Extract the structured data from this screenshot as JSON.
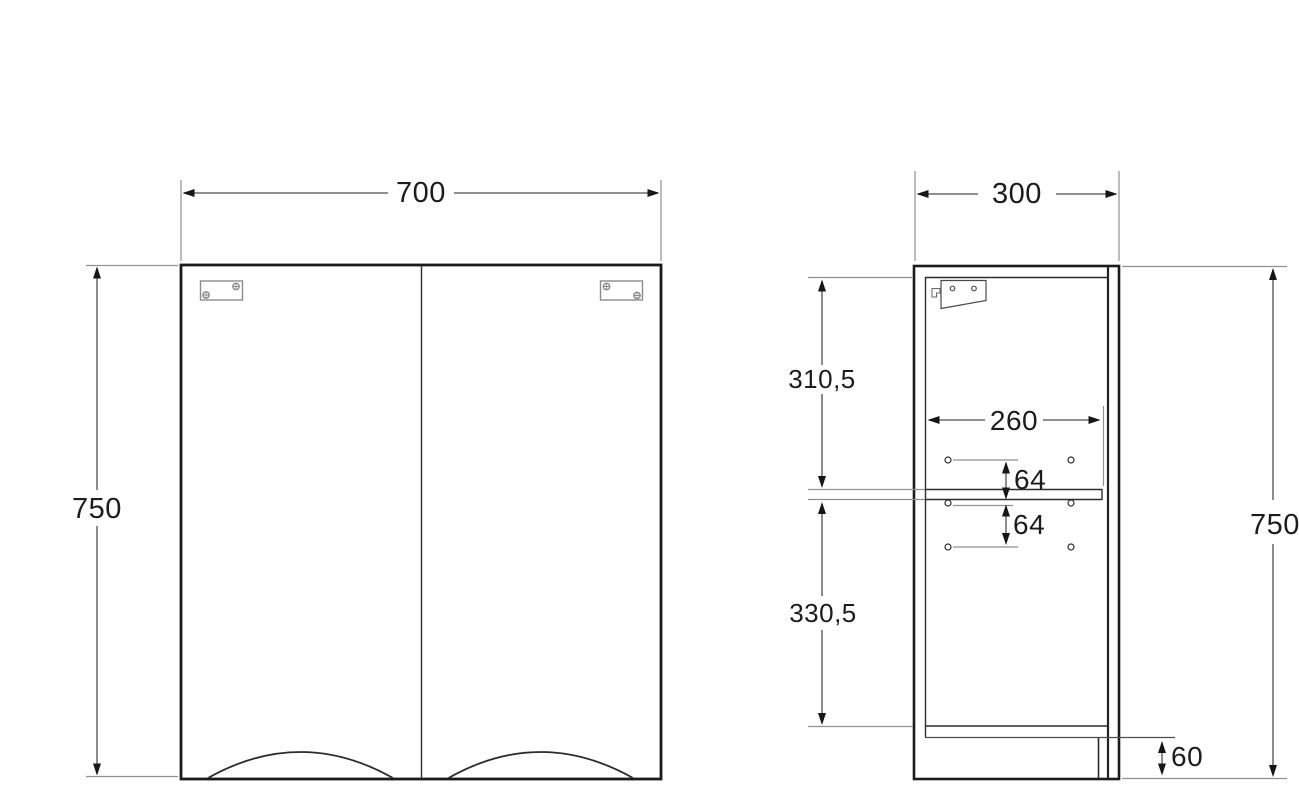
{
  "drawing": {
    "title": "cabinet-technical-drawing",
    "units": "mm",
    "colors": {
      "background": "#ffffff",
      "outline": "#1b1b1b",
      "dimension_line": "#4d4d4d",
      "extension_line": "#8f8f8f",
      "hardware": "#8b8b8b"
    },
    "front_view": {
      "width_label": "700",
      "height_label": "750"
    },
    "side_view": {
      "depth_label": "300",
      "height_label": "750",
      "top_to_shelf_label": "310,5",
      "shelf_to_bottom_label": "330,5",
      "internal_depth_label": "260",
      "hole_pitch_upper_label": "64",
      "hole_pitch_lower_label": "64",
      "bottom_offset_label": "60"
    }
  }
}
